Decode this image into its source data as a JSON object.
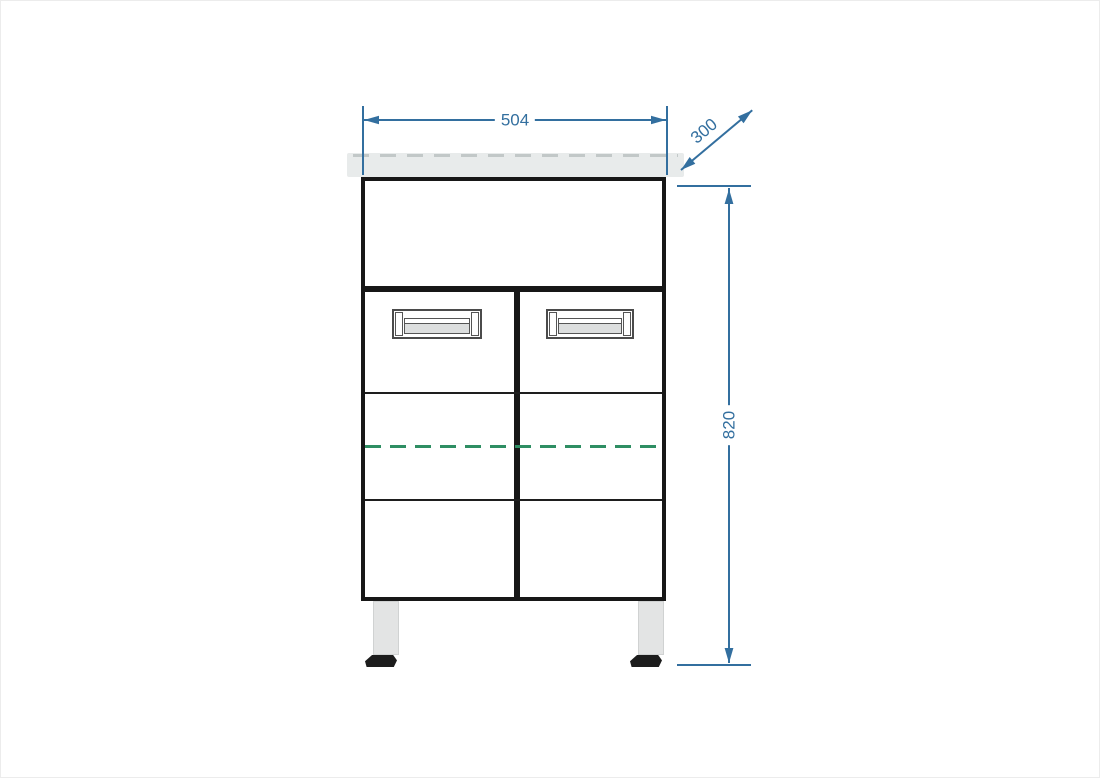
{
  "drawing": {
    "type": "cabinet-front-elevation",
    "dimensions": {
      "width": "504",
      "depth": "300",
      "height": "820"
    },
    "colors": {
      "dimension_blue": "#336f9f",
      "outline_black": "#171717",
      "shelf_dash_green": "#2e8e63",
      "countertop_gray": "#e8ebeb",
      "handle_gray": "#dcdede",
      "leg_gray": "#e3e4e4",
      "foot_black": "#1c1c1c"
    }
  }
}
